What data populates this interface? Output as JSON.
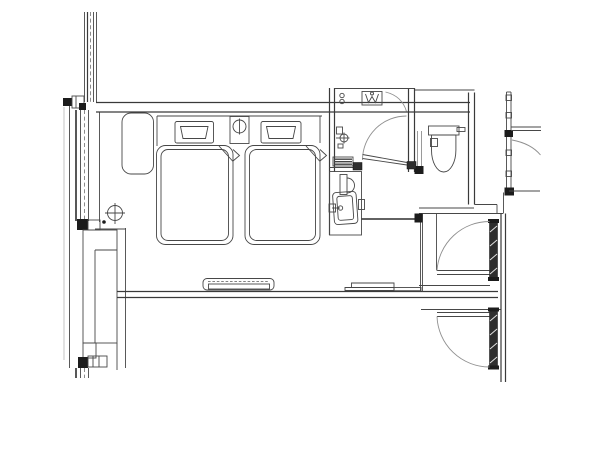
{
  "canvas": {
    "width": 600,
    "height": 450,
    "background": "#ffffff"
  },
  "drawing": {
    "kind": "architectural-floor-plan",
    "subject": "hotel-guestroom-twin-bed-unit",
    "colors": {
      "line": "#474747",
      "light_line": "#8f8f8f",
      "dashed_line": "#6f6f6f",
      "solid_fill": "#1c1c1c",
      "door_leaf_fill": "#2e2e2e",
      "background": "#ffffff"
    },
    "elements": [
      "curtain-wall-window",
      "window-mullion-joints",
      "window-bay-cabinet",
      "column-grid-marker",
      "lounge-chair",
      "twin-bed-left",
      "twin-bed-right",
      "pillow-left",
      "pillow-right",
      "nightstand-with-lamp",
      "shower-room",
      "shower-door-swing",
      "shower-mixer-fixture",
      "shower-threshold",
      "washbasin-vanity",
      "vanity-faucet",
      "toilet-with-cistern",
      "luggage-bench-counter",
      "entry-vestibule",
      "entry-door-upper",
      "entry-door-lower",
      "corridor-wall",
      "glazed-partition-right",
      "adjacent-unit-door-swings",
      "adjacent-unit-basin",
      "wall-console-dashed",
      "tv-console",
      "partition-walls"
    ],
    "counts": {
      "beds": 2,
      "pillows": 2,
      "entry-doors": 2,
      "door-swing-arcs": 5
    }
  }
}
